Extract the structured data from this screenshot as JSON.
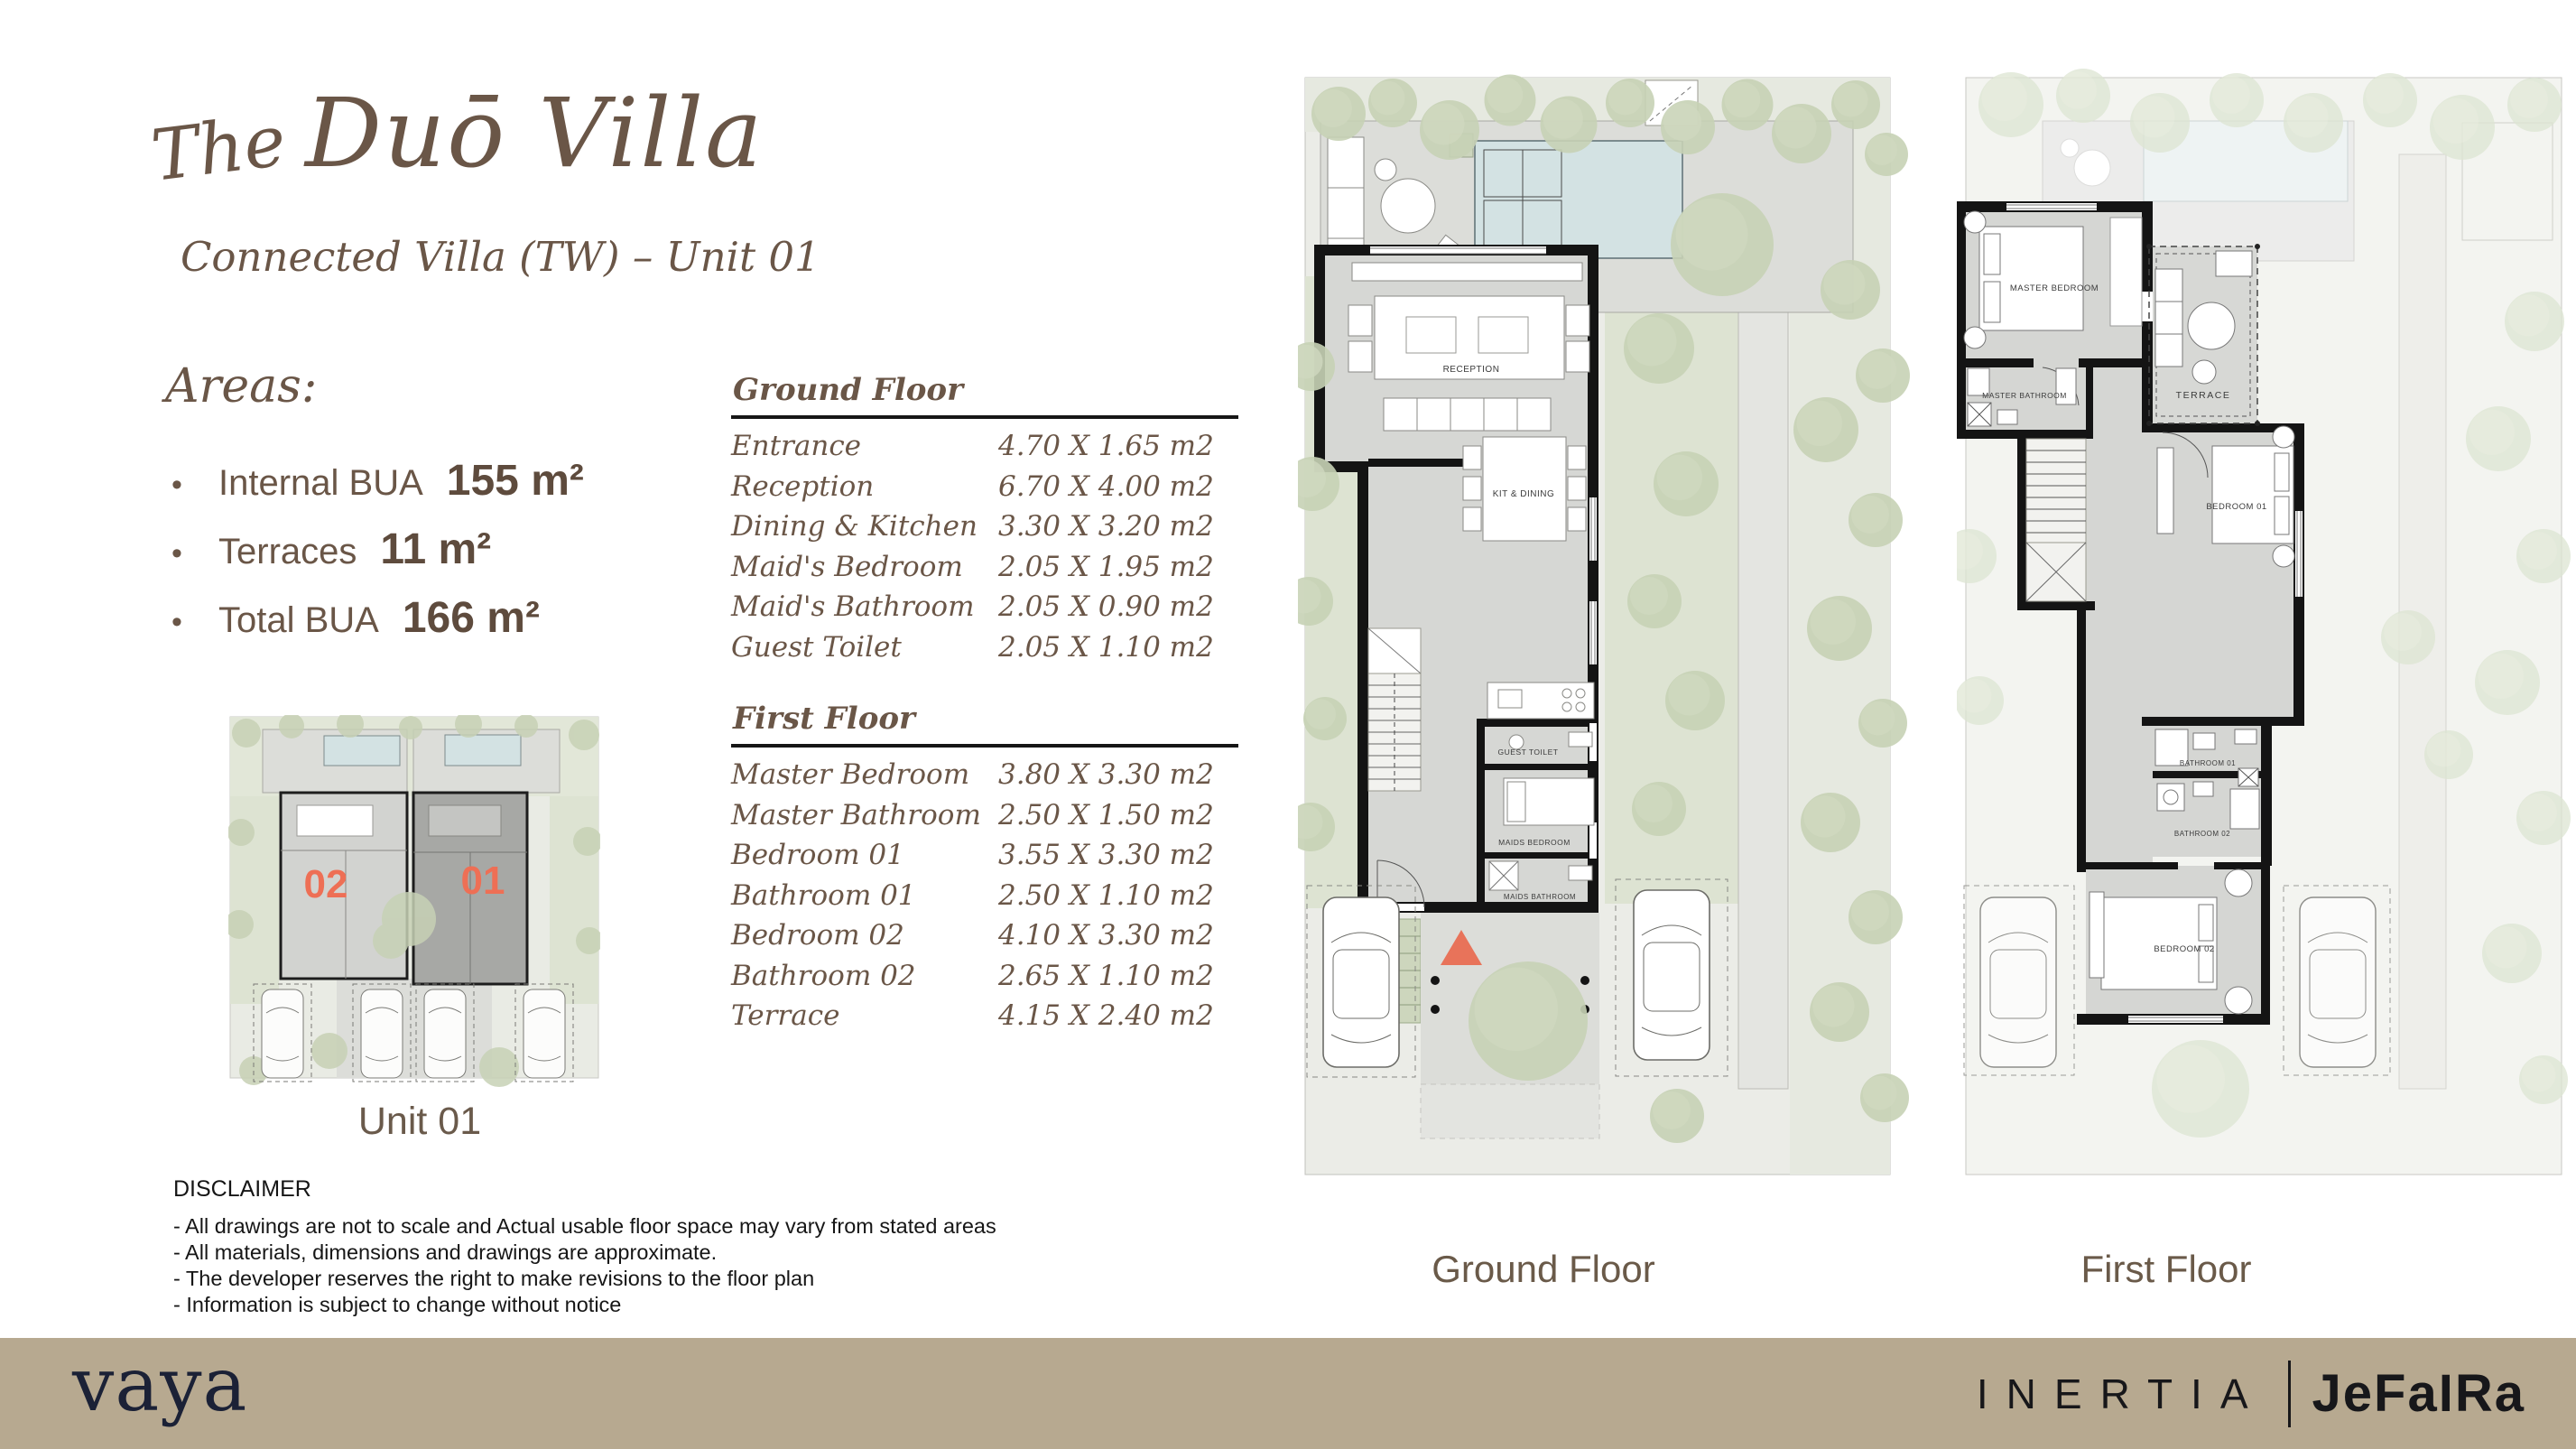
{
  "header": {
    "script_word": "The",
    "title": "Duō Villa",
    "subtitle": "Connected Villa (TW) – Unit 01"
  },
  "areas": {
    "heading": "Areas:",
    "bullet": "•",
    "items": [
      {
        "label": "Internal BUA",
        "value": "155 m²"
      },
      {
        "label": "Terraces",
        "value": "11 m²"
      },
      {
        "label": "Total BUA",
        "value": "166 m²"
      }
    ]
  },
  "site_plan": {
    "unit_left_label": "02",
    "unit_right_label": "01",
    "caption": "Unit 01"
  },
  "tables": [
    {
      "title": "Ground Floor",
      "rows": [
        {
          "room": "Entrance",
          "dims": "4.70 X 1.65 m2"
        },
        {
          "room": "Reception",
          "dims": "6.70 X 4.00 m2"
        },
        {
          "room": "Dining & Kitchen",
          "dims": "3.30 X 3.20 m2"
        },
        {
          "room": "Maid's Bedroom",
          "dims": "2.05 X 1.95 m2"
        },
        {
          "room": "Maid's Bathroom",
          "dims": "2.05 X 0.90 m2"
        },
        {
          "room": "Guest Toilet",
          "dims": "2.05 X 1.10 m2"
        }
      ]
    },
    {
      "title": "First Floor",
      "rows": [
        {
          "room": "Master Bedroom",
          "dims": "3.80 X 3.30 m2"
        },
        {
          "room": "Master Bathroom",
          "dims": "2.50 X 1.50 m2"
        },
        {
          "room": "Bedroom 01",
          "dims": "3.55 X 3.30 m2"
        },
        {
          "room": "Bathroom 01",
          "dims": "2.50 X 1.10 m2"
        },
        {
          "room": "Bedroom 02",
          "dims": "4.10 X 3.30 m2"
        },
        {
          "room": "Bathroom 02",
          "dims": "2.65 X 1.10 m2"
        },
        {
          "room": "Terrace",
          "dims": "4.15 X 2.40 m2"
        }
      ]
    }
  ],
  "plans": {
    "ground": {
      "caption": "Ground Floor",
      "labels": {
        "reception": "RECEPTION",
        "kitchen": "KIT & DINING",
        "guest_toilet": "GUEST TOILET",
        "maids_bedroom": "MAIDS BEDROOM",
        "maids_bathroom": "MAIDS BATHROOM"
      }
    },
    "first": {
      "caption": "First Floor",
      "labels": {
        "master_bedroom": "MASTER BEDROOM",
        "master_bathroom": "MASTER BATHROOM",
        "terrace": "TERRACE",
        "bedroom_01": "BEDROOM 01",
        "bathroom_01": "BATHROOM 01",
        "bathroom_02": "BATHROOM 02",
        "bedroom_02": "BEDROOM 02"
      }
    }
  },
  "disclaimer": {
    "heading": "DISCLAIMER",
    "lines": [
      "- All drawings are not to scale and Actual usable floor space may vary from stated areas",
      "- All materials, dimensions and drawings are approximate.",
      "- The developer reserves the right to make revisions to the floor plan",
      "- Information is subject to change without notice"
    ]
  },
  "footer": {
    "brand_left": "vaya",
    "brand_right_primary": "INERTIA",
    "brand_right_secondary": "JeFaIRa"
  },
  "colors": {
    "accent_brown": "#6a5647",
    "accent_coral": "#e8735a",
    "footer_bar": "#b7a990",
    "brand_navy": "#1b2136",
    "tree_green": "#c7d1b5",
    "pool_blue": "#d3e2e3"
  }
}
